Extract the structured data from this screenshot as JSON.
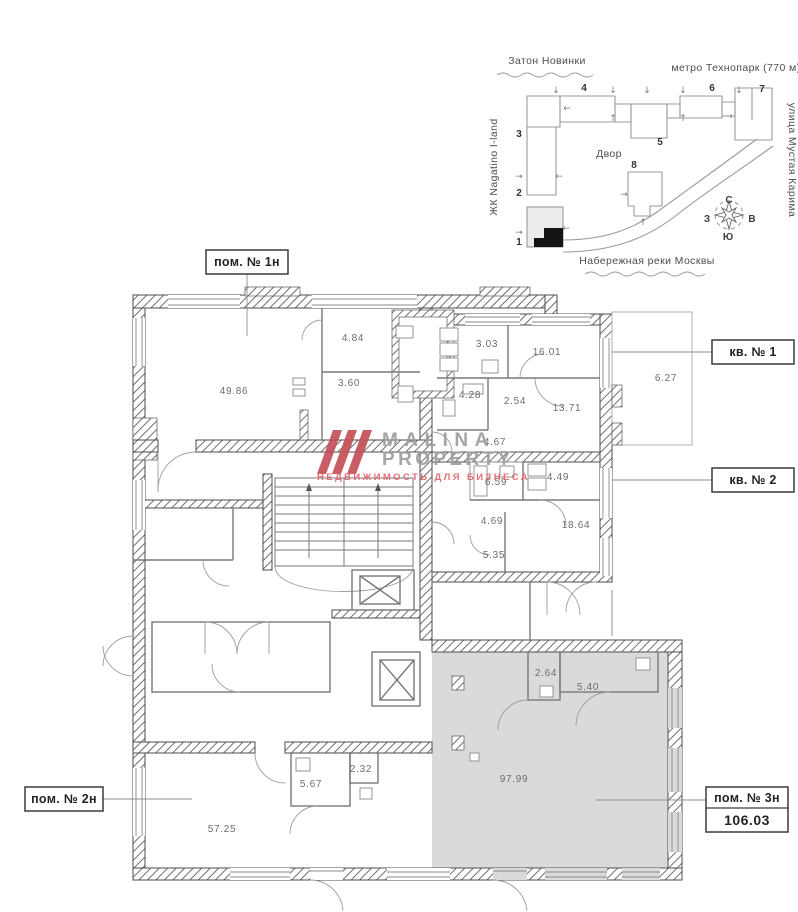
{
  "site_plan": {
    "label_top_left": "Затон Новинки",
    "label_top_right": "метро Технопарк (770 м)",
    "label_left": "ЖК Nagatino I-land",
    "label_right": "улица Мустая Карима",
    "label_bottom": "Набережная реки Москвы",
    "courtyard": "Двор",
    "buildings": [
      "1",
      "2",
      "3",
      "4",
      "5",
      "6",
      "7",
      "8"
    ],
    "compass": {
      "n": "С",
      "e": "В",
      "s": "Ю",
      "w": "З"
    },
    "arrows": {
      "up": "↑",
      "down": "↓",
      "left": "←",
      "right": "→"
    }
  },
  "callouts": {
    "unit1_label": "пом. № 1н",
    "apt1_label": "кв. № 1",
    "apt2_label": "кв. № 2",
    "unit2_label": "пом. № 2н",
    "unit3_label": "пом. № 3н",
    "unit3_area": "106.03"
  },
  "rooms": [
    {
      "area": "49.86"
    },
    {
      "area": "4.84"
    },
    {
      "area": "3.60"
    },
    {
      "area": "3.03"
    },
    {
      "area": "16.01"
    },
    {
      "area": "6.27"
    },
    {
      "area": "2.54"
    },
    {
      "area": "13.71"
    },
    {
      "area": "4.28"
    },
    {
      "area": "4.67"
    },
    {
      "area": "6.59"
    },
    {
      "area": "4.49"
    },
    {
      "area": "4.69"
    },
    {
      "area": "18.64"
    },
    {
      "area": "5.35"
    },
    {
      "area": "2.64"
    },
    {
      "area": "5.40"
    },
    {
      "area": "97.99"
    },
    {
      "area": "5.67"
    },
    {
      "area": "2.32"
    },
    {
      "area": "57.25"
    }
  ],
  "watermark": {
    "brand_line1": "MALINA",
    "brand_line2": "PROPERTY",
    "tagline": "НЕДВИЖИМОСТЬ ДЛЯ БИЗНЕСА",
    "accent_color": "#c4505a"
  },
  "colors": {
    "unit3_fill": "#dadada",
    "wall": "#4d4d4d",
    "highlight_building": "#141414"
  }
}
